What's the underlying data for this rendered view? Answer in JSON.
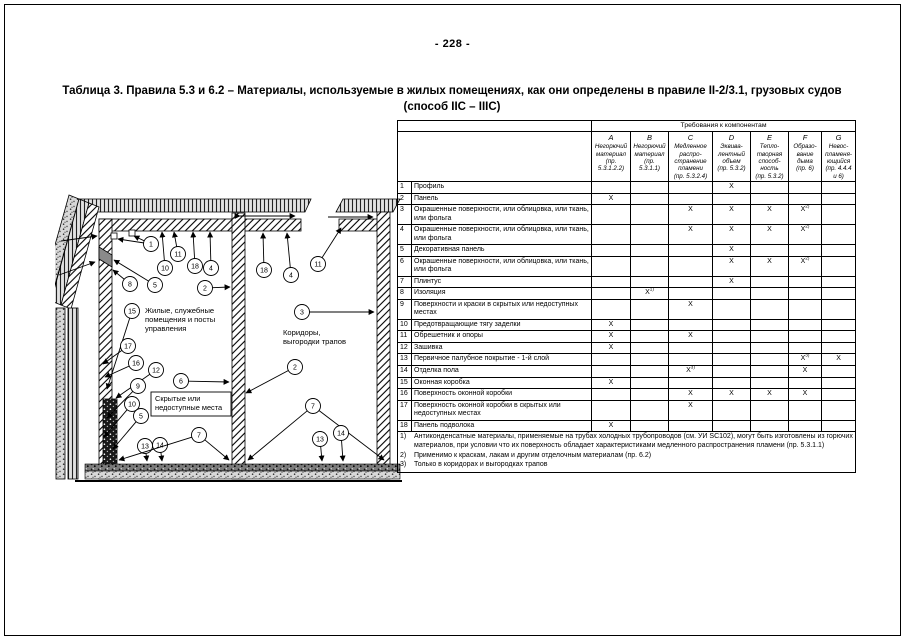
{
  "page": {
    "number": "- 228 -",
    "title": "Таблица 3. Правила 5.3 и 6.2 – Материалы, используемые в жилых помещениях, как они определены в правиле II-2/3.1, грузовых судов (способ IIC – IIIC)"
  },
  "diagram": {
    "labels": {
      "room_left": "Жилые, служебные\nпомещения и посты\nуправления",
      "room_right": "Коридоры,\nвыгородки трапов",
      "hidden_box": "Скрытые или\nнедоступные места"
    },
    "callouts": [
      {
        "n": "1",
        "x": 96,
        "y": 61,
        "leaders": [
          [
            63,
            56
          ],
          [
            79,
            53
          ]
        ]
      },
      {
        "n": "11",
        "x": 123,
        "y": 71,
        "leaders": [
          [
            119,
            49
          ]
        ]
      },
      {
        "n": "10",
        "x": 110,
        "y": 85,
        "leaders": [
          [
            107,
            49
          ]
        ]
      },
      {
        "n": "18",
        "x": 140,
        "y": 83,
        "leaders": [
          [
            138,
            49
          ]
        ]
      },
      {
        "n": "4",
        "x": 156,
        "y": 85,
        "leaders": [
          [
            155,
            49
          ]
        ]
      },
      {
        "n": "8",
        "x": 75,
        "y": 101,
        "leaders": [
          [
            58,
            87
          ]
        ]
      },
      {
        "n": "5",
        "x": 100,
        "y": 102,
        "leaders": [
          [
            59,
            77
          ]
        ]
      },
      {
        "n": "2",
        "x": 150,
        "y": 105,
        "leaders": [
          [
            175,
            104
          ]
        ]
      },
      {
        "n": "15",
        "x": 77,
        "y": 128,
        "leaders": [
          [
            52,
            206
          ]
        ]
      },
      {
        "n": "18",
        "x": 209,
        "y": 87,
        "leaders": [
          [
            208,
            50
          ]
        ]
      },
      {
        "n": "4",
        "x": 236,
        "y": 92,
        "leaders": [
          [
            232,
            50
          ]
        ]
      },
      {
        "n": "11",
        "x": 263,
        "y": 81,
        "leaders": [
          [
            286,
            45
          ]
        ]
      },
      {
        "n": "3",
        "x": 247,
        "y": 129,
        "leaders": [
          [
            319,
            129
          ]
        ]
      },
      {
        "n": "17",
        "x": 73,
        "y": 163,
        "leaders": [
          [
            48,
            181
          ]
        ]
      },
      {
        "n": "16",
        "x": 81,
        "y": 180,
        "leaders": [
          [
            50,
            194
          ]
        ]
      },
      {
        "n": "12",
        "x": 101,
        "y": 187,
        "leaders": [
          [
            61,
            215
          ]
        ]
      },
      {
        "n": "9",
        "x": 83,
        "y": 203,
        "leaders": [
          [
            52,
            235
          ]
        ]
      },
      {
        "n": "6",
        "x": 126,
        "y": 198,
        "leaders": [
          [
            174,
            199
          ]
        ]
      },
      {
        "n": "10",
        "x": 77,
        "y": 221,
        "leaders": [
          [
            49,
            254
          ]
        ]
      },
      {
        "n": "5",
        "x": 86,
        "y": 233,
        "leaders": [
          [
            58,
            266
          ]
        ]
      },
      {
        "n": "13",
        "x": 90,
        "y": 263,
        "leaders": [
          [
            92,
            278
          ]
        ]
      },
      {
        "n": "14",
        "x": 105,
        "y": 262,
        "leaders": [
          [
            107,
            278
          ]
        ]
      },
      {
        "n": "7",
        "x": 144,
        "y": 252,
        "leaders": [
          [
            64,
            277
          ],
          [
            174,
            277
          ]
        ]
      },
      {
        "n": "2",
        "x": 240,
        "y": 184,
        "leaders": [
          [
            191,
            210
          ]
        ]
      },
      {
        "n": "7",
        "x": 258,
        "y": 223,
        "leaders": [
          [
            193,
            277
          ],
          [
            329,
            277
          ]
        ]
      },
      {
        "n": "13",
        "x": 265,
        "y": 256,
        "leaders": [
          [
            267,
            278
          ]
        ]
      },
      {
        "n": "14",
        "x": 286,
        "y": 250,
        "leaders": [
          [
            288,
            278
          ]
        ]
      }
    ]
  },
  "table": {
    "group_header": "Требования к компонентам",
    "columns": [
      {
        "letter": "A",
        "desc": "Негорючий\nматериал\n(пр. 5.3.1.2.2)"
      },
      {
        "letter": "B",
        "desc": "Негорючий\nматериал\n(пр. 5.3.1.1)"
      },
      {
        "letter": "C",
        "desc": "Медленное\nраспро-\nстранение\nпламени\n(пр. 5.3.2.4)"
      },
      {
        "letter": "D",
        "desc": "Эквива-\nлентный\nобъем\n(пр. 5.3.2)"
      },
      {
        "letter": "E",
        "desc": "Тепло-\nтворная\nспособ-\nность\n(пр. 5.3.2)"
      },
      {
        "letter": "F",
        "desc": "Образо-\nвание\nдыма\n(пр. 6)"
      },
      {
        "letter": "G",
        "desc": "Невос-\nпламеня-\nющийся\n(пр. 4.4.4\nи 6)"
      }
    ],
    "rows": [
      {
        "num": "1",
        "label": "Профиль",
        "marks": [
          "",
          "",
          "",
          "X",
          "",
          "",
          ""
        ]
      },
      {
        "num": "2",
        "label": "Панель",
        "marks": [
          "X",
          "",
          "",
          "",
          "",
          "",
          ""
        ]
      },
      {
        "num": "3",
        "label": "Окрашенные поверхности, или облицовка, или ткань, или фольга",
        "marks": [
          "",
          "",
          "X",
          "X",
          "X",
          "X2)",
          ""
        ]
      },
      {
        "num": "4",
        "label": "Окрашенные поверхности, или облицовка, или ткань, или фольга",
        "marks": [
          "",
          "",
          "X",
          "X",
          "X",
          "X2)",
          ""
        ]
      },
      {
        "num": "5",
        "label": "Декоративная панель",
        "marks": [
          "",
          "",
          "",
          "X",
          "",
          "",
          ""
        ]
      },
      {
        "num": "6",
        "label": "Окрашенные поверхности, или облицовка, или ткань, или фольга",
        "marks": [
          "",
          "",
          "",
          "X",
          "X",
          "X2)",
          ""
        ]
      },
      {
        "num": "7",
        "label": "Плинтус",
        "marks": [
          "",
          "",
          "",
          "X",
          "",
          "",
          ""
        ]
      },
      {
        "num": "8",
        "label": "Изоляция",
        "marks": [
          "",
          "X1)",
          "",
          "",
          "",
          "",
          ""
        ]
      },
      {
        "num": "9",
        "label": "Поверхности и краски в скрытых или недоступных местах",
        "marks": [
          "",
          "",
          "X",
          "",
          "",
          "",
          ""
        ]
      },
      {
        "num": "10",
        "label": "Предотвращающие тягу заделки",
        "marks": [
          "X",
          "",
          "",
          "",
          "",
          "",
          ""
        ]
      },
      {
        "num": "11",
        "label": "Обрешетник и опоры",
        "marks": [
          "X",
          "",
          "X",
          "",
          "",
          "",
          ""
        ]
      },
      {
        "num": "12",
        "label": "Зашивка",
        "marks": [
          "X",
          "",
          "",
          "",
          "",
          "",
          ""
        ]
      },
      {
        "num": "13",
        "label": "Первичное палубное покрытие - 1-й слой",
        "marks": [
          "",
          "",
          "",
          "",
          "",
          "X3)",
          "X"
        ]
      },
      {
        "num": "14",
        "label": "Отделка пола",
        "marks": [
          "",
          "",
          "X3)",
          "",
          "",
          "X",
          ""
        ]
      },
      {
        "num": "15",
        "label": "Оконная коробка",
        "marks": [
          "X",
          "",
          "",
          "",
          "",
          "",
          ""
        ]
      },
      {
        "num": "16",
        "label": "Поверхность оконной коробки",
        "marks": [
          "",
          "",
          "X",
          "X",
          "X",
          "X",
          ""
        ]
      },
      {
        "num": "17",
        "label": "Поверхность оконной коробки в скрытых или недоступных местах",
        "marks": [
          "",
          "",
          "X",
          "",
          "",
          "",
          ""
        ]
      },
      {
        "num": "18",
        "label": "Панель подволока",
        "marks": [
          "X",
          "",
          "",
          "",
          "",
          "",
          ""
        ]
      }
    ],
    "footnotes": [
      {
        "num": "1)",
        "text": "Антиконденсатные материалы, применяемые на трубах холодных трубопроводов (см. УИ SC102), могут быть изготовлены из горючих материалов, при условии что их поверхность обладает характеристиками медленного распространения пламени (пр. 5.3.1.1)"
      },
      {
        "num": "2)",
        "text": "Применимо к краскам, лакам и другим отделочным материалам (пр. 6.2)"
      },
      {
        "num": "3)",
        "text": "Только в коридорах и выгородках трапов"
      }
    ]
  }
}
